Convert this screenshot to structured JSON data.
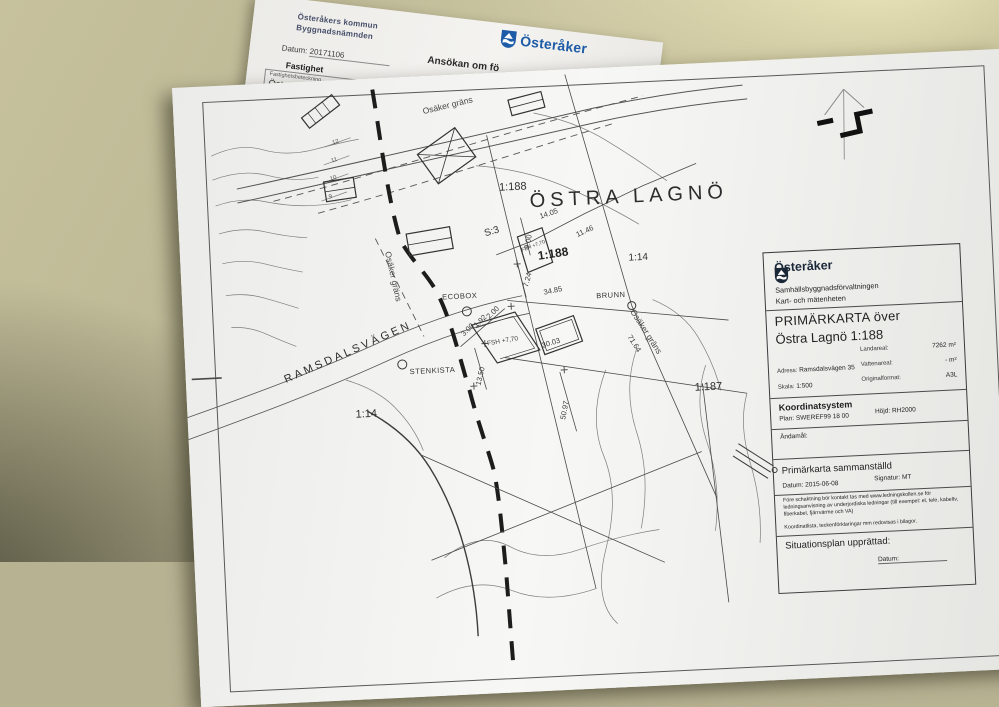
{
  "form": {
    "sender_line1": "Österåkers kommun",
    "sender_line2": "Byggnadsnämnden",
    "date_label": "Datum:",
    "date_value": "20171106",
    "property_section": "Fastighet",
    "property_field_label": "Fastighetsbeteckning",
    "property_field_value": "Östra Lagn",
    "heading_fragment": "Ansökan om fö",
    "logo_text": "Österåker"
  },
  "map": {
    "labels": {
      "boundary_top": "Osäker gräns",
      "boundary_left": "Osäker gräns",
      "boundary_right": "Osäker gräns",
      "area_name": "ÖSTRA LAGNÖ",
      "parcel_1188_a": "1:188",
      "parcel_1188_b": "1:188",
      "parcel_s3": "S:3",
      "parcel_114_a": "1:14",
      "parcel_114_b": "1:14",
      "parcel_1187": "1:187",
      "road_name": "RAMSDALSVÄGEN",
      "poi_ecobox": "ECOBOX",
      "poi_brunn": "BRUNN",
      "poi_stenkista": "STENKISTA",
      "house_fbh": "FBH +7,70",
      "house_fsh": "FSH +7,70",
      "d14_05": "14.05",
      "d11_46": "11.46",
      "d9_00": "9.00",
      "d7_24": "7.24",
      "d34_85": "34.85",
      "d3_00": "3.00",
      "d1_92": "1.92",
      "d2_00": "2.00",
      "d30_03": "30.03",
      "d71_64": "71.64",
      "d13_50": "13.50",
      "d50_97": "50.97",
      "c12": "12",
      "c11": "11",
      "c10": "10",
      "c9": "9"
    },
    "title_block": {
      "logo_text": "Österåker",
      "department_line1": "Samhällsbyggnadsförvaltningen",
      "department_line2": "Kart- och mätenheten",
      "title_line1": "PRIMÄRKARTA över",
      "title_line2": "Östra Lagnö 1:188",
      "address_label": "Adress:",
      "address_value": "Ramsdalsvägen 35",
      "scale_label": "Skala:",
      "scale_value": "1:500",
      "land_area_label": "Landareal:",
      "land_area_value": "7262 m²",
      "water_area_label": "Vattenareal:",
      "water_area_value": "- m²",
      "format_label": "Originalformat:",
      "format_value": "A3L",
      "coord_heading": "Koordinatsystem",
      "coord_plan_label": "Plan:",
      "coord_plan_value": "SWEREF99 18 00",
      "coord_height_label": "Höjd:",
      "coord_height_value": "RH2000",
      "purpose_label": "Ändamål:",
      "compiled_heading": "Primärkarta sammanställd",
      "compiled_date_label": "Datum:",
      "compiled_date_value": "2015-06-08",
      "signature_label": "Signatur:",
      "signature_value": "MT",
      "note1": "Före schaktning bör kontakt tas med www.ledningskollen.se för ledningsanvisning av underjordiska ledningar (till exempel: el, tele, kabeltv, fiberkabel, fjärrvärme och VA)",
      "note2": "Koordinatlista, teckenförklaringar mm redovisas i bilagor.",
      "situation_heading": "Situationsplan upprättad:",
      "situation_date_label": "Datum:"
    }
  },
  "colors": {
    "logo_blue": "#1e5ca8",
    "paper": "#f1f0ee",
    "table": "#b7b292",
    "map_ink": "#2f2f2f"
  }
}
